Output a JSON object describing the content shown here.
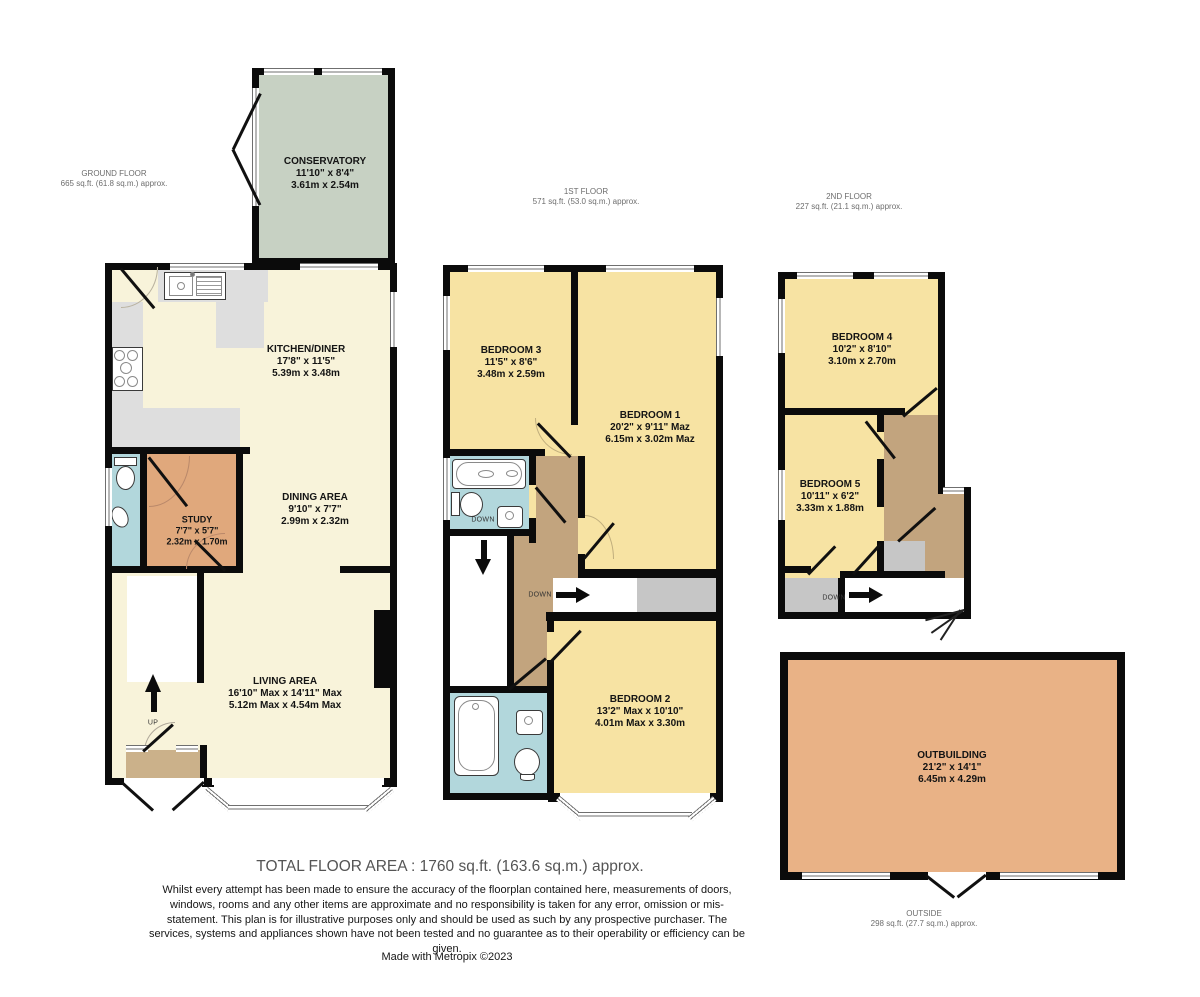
{
  "floors": {
    "ground": {
      "title": "GROUND FLOOR",
      "area": "665 sq.ft. (61.8 sq.m.) approx."
    },
    "first": {
      "title": "1ST FLOOR",
      "area": "571 sq.ft. (53.0 sq.m.) approx."
    },
    "second": {
      "title": "2ND FLOOR",
      "area": "227 sq.ft. (21.1 sq.m.) approx."
    },
    "outside": {
      "title": "OUTSIDE",
      "area": "298 sq.ft. (27.7 sq.m.) approx."
    }
  },
  "rooms": {
    "conservatory": {
      "name": "CONSERVATORY",
      "size_ft": "11'10\"  x 8'4\"",
      "size_m": "3.61m  x 2.54m"
    },
    "kitchen_diner": {
      "name": "KITCHEN/DINER",
      "size_ft": "17'8\"  x 11'5\"",
      "size_m": "5.39m  x 3.48m"
    },
    "study": {
      "name": "STUDY",
      "size_ft": "7'7\"  x 5'7\"",
      "size_m": "2.32m  x 1.70m"
    },
    "dining_area": {
      "name": "DINING AREA",
      "size_ft": "9'10\"  x 7'7\"",
      "size_m": "2.99m  x 2.32m"
    },
    "living_area": {
      "name": "LIVING AREA",
      "size_ft": "16'10\" Max x 14'11\" Max",
      "size_m": "5.12m Max x 4.54m Max"
    },
    "bedroom1": {
      "name": "BEDROOM 1",
      "size_ft": "20'2\"  x 9'11\" Maz",
      "size_m": "6.15m  x 3.02m Maz"
    },
    "bedroom2": {
      "name": "BEDROOM 2",
      "size_ft": "13'2\" Max x 10'10\"",
      "size_m": "4.01m Max x 3.30m"
    },
    "bedroom3": {
      "name": "BEDROOM 3",
      "size_ft": "11'5\"  x 8'6\"",
      "size_m": "3.48m  x 2.59m"
    },
    "bedroom4": {
      "name": "BEDROOM 4",
      "size_ft": "10'2\"  x 8'10\"",
      "size_m": "3.10m  x 2.70m"
    },
    "bedroom5": {
      "name": "BEDROOM 5",
      "size_ft": "10'11\"  x 6'2\"",
      "size_m": "3.33m  x 1.88m"
    },
    "outbuilding": {
      "name": "OUTBUILDING",
      "size_ft": "21'2\"  x 14'1\"",
      "size_m": "6.45m  x 4.29m"
    }
  },
  "stairs": {
    "up_label": "UP",
    "down_label": "DOWN"
  },
  "footer": {
    "total": "TOTAL FLOOR AREA : 1760 sq.ft. (163.6 sq.m.) approx.",
    "disclaimer": "Whilst every attempt has been made to ensure the accuracy of the floorplan contained here, measurements of doors, windows, rooms and any other items are approximate and no responsibility is taken for any error, omission or mis-statement. This plan is for illustrative purposes only and should be used as such by any prospective purchaser. The services, systems and appliances shown have not been tested and no guarantee as to their operability or efficiency can be given.",
    "credit": "Made with Metropix ©2023"
  },
  "palette": {
    "wall": "#0b0b0b",
    "cream": "#f8f3da",
    "bedroom_yellow": "#f7e3a3",
    "bathroom_blue": "#b2d7dc",
    "study_orange": "#e0a87c",
    "outbuilding_orange": "#e9b286",
    "conservatory_green": "#c7d1c3",
    "landing_brown": "#c2a47e",
    "porch_tan": "#cbb18a",
    "counter_gray": "#dedede",
    "area_gray": "#c6c6c6"
  }
}
